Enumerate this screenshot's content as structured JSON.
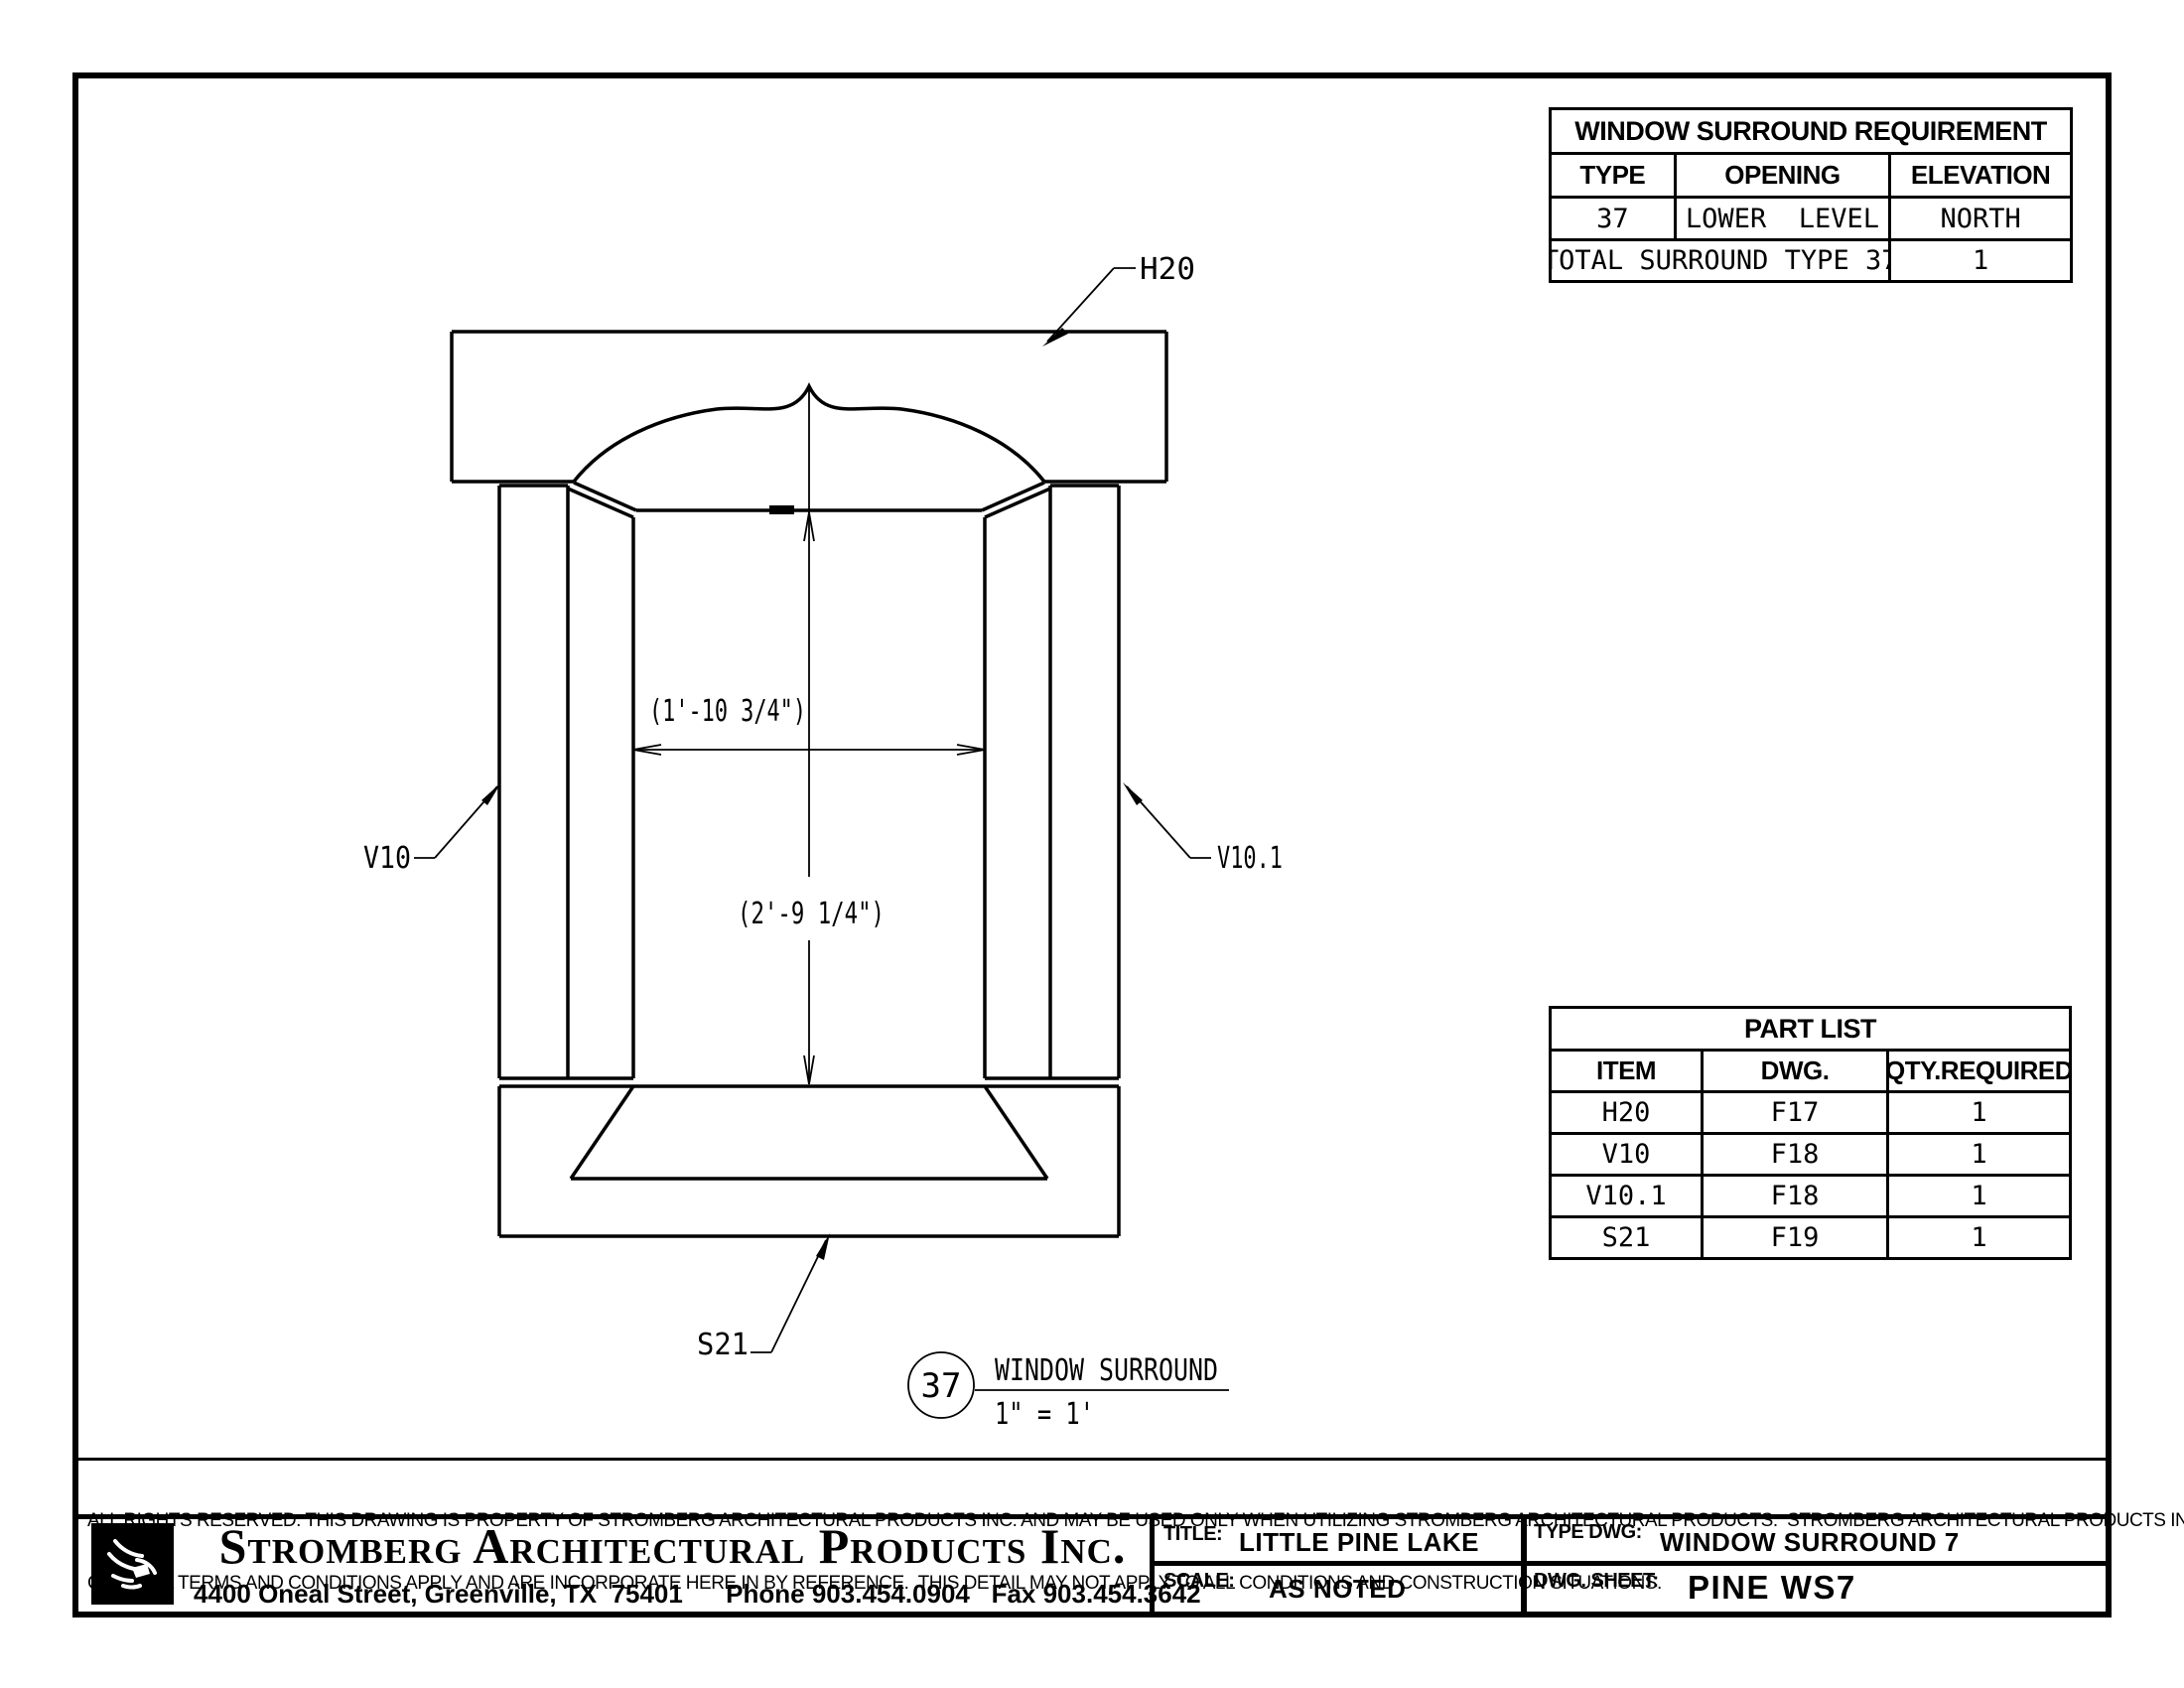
{
  "drawing": {
    "header_label": "H20",
    "left_jamb_label": "V10",
    "right_jamb_label": "V10.1",
    "sill_label": "S21",
    "width_dim": "(1'-10 3/4\")",
    "height_dim": "(2'-9 1/4\")",
    "callout_number": "37",
    "callout_title": "WINDOW SURROUND",
    "callout_scale": "1\" = 1'"
  },
  "requirement_table": {
    "title": "WINDOW SURROUND REQUIREMENT",
    "columns": [
      "TYPE",
      "OPENING",
      "ELEVATION"
    ],
    "row": [
      "37",
      "LOWER  LEVEL",
      "NORTH"
    ],
    "total_label": "TOTAL SURROUND TYPE 37",
    "total_value": "1"
  },
  "part_list": {
    "title": "PART LIST",
    "columns": [
      "ITEM",
      "DWG.",
      "QTY.REQUIRED"
    ],
    "rows": [
      [
        "H20",
        "F17",
        "1"
      ],
      [
        "V10",
        "F18",
        "1"
      ],
      [
        "V10.1",
        "F18",
        "1"
      ],
      [
        "S21",
        "F19",
        "1"
      ]
    ]
  },
  "legal": {
    "line1": "ALL RIGHTS RESERVED. THIS DRAWING IS PROPERTY OF STROMBERG ARCHITECTURAL PRODUCTS INC. AND MAY BE USED ONLY WHEN UTILIZING STROMBERG ARCHITECTURAL PRODUCTS.  STROMBERG ARCHITECTURAL PRODUCTS INC.",
    "line2": "GENERAL TERMS AND CONDITIONS APPLY AND ARE INCORPORATE HERE IN BY REFERENCE.  THIS DETAIL MAY NOT APPLY TO ALL CONDITIONS AND CONSTRUCTION SITUATIONS."
  },
  "title_block": {
    "company": "Stromberg Architectural Products Inc.",
    "address": "4400 Oneal Street, Greenville, TX  75401      Phone 903.454.0904   Fax 903.454.3642",
    "title_label": "TITLE:",
    "title_value": "LITTLE PINE LAKE",
    "type_label": "TYPE DWG:",
    "type_value": "WINDOW SURROUND 7",
    "scale_label": "SCALE:",
    "scale_value": "AS NOTED",
    "sheet_label": "DWG. SHEET:",
    "sheet_value": "PINE WS7"
  }
}
